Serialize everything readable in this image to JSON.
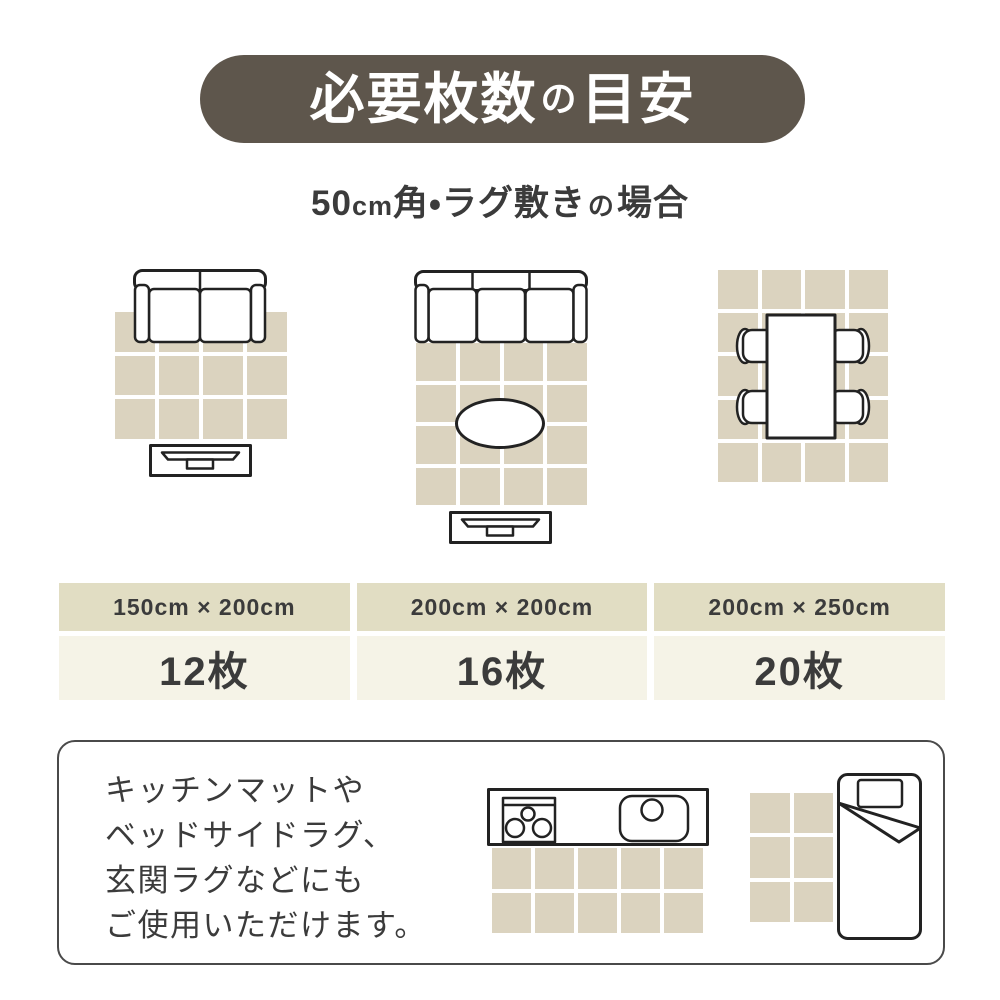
{
  "colors": {
    "banner_bg": "#5e564c",
    "tile": "#dbd3bf",
    "table_header_bg": "#e1ddc3",
    "table_value_bg": "#f5f3e7",
    "text": "#3b3b3b",
    "line": "#222222",
    "note_border": "#4a4a4a"
  },
  "header": {
    "title_parts": [
      "必要枚数",
      "の",
      "目安"
    ],
    "subtitle_parts": [
      "50",
      "cm",
      "角・ラグ敷き",
      "の",
      "場合"
    ]
  },
  "diagrams": [
    {
      "name": "living-room-2seat-sofa-tv-board",
      "tiles": 12,
      "grid": {
        "cols": 4,
        "rows": 3
      }
    },
    {
      "name": "living-room-3seat-sofa-oval-table-tv-board",
      "tiles": 16,
      "grid": {
        "cols": 4,
        "rows": 4
      }
    },
    {
      "name": "dining-table-with-four-chairs",
      "tiles": 20,
      "grid": {
        "cols": 4,
        "rows": 5
      }
    }
  ],
  "size_table": {
    "columns": [
      {
        "size": "150cm × 200cm",
        "count": "12枚"
      },
      {
        "size": "200cm × 200cm",
        "count": "16枚"
      },
      {
        "size": "200cm × 250cm",
        "count": "20枚"
      }
    ]
  },
  "note": {
    "lines": [
      "キッチンマットや",
      "ベッドサイドラグ、",
      "玄関ラグなどにも",
      "ご使用いただけます。"
    ],
    "kitchen_grid": {
      "cols": 5,
      "rows": 2
    },
    "bedside_grid": {
      "cols": 2,
      "rows": 3
    }
  }
}
